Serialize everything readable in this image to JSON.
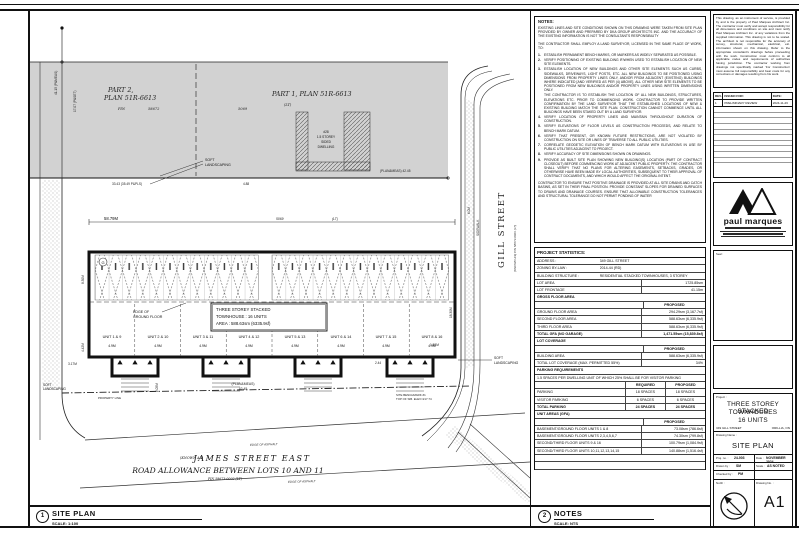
{
  "page": {
    "footer_left": {
      "num": "1",
      "title": "SITE PLAN",
      "scale": "SCALE: 1:100"
    },
    "footer_mid": {
      "num": "2",
      "title": "NOTES",
      "scale": "SCALE: NTS"
    }
  },
  "plan": {
    "part2_line1": "PART 2,",
    "part2_line2": "PLAN 51R-6613",
    "pin_label": "PIN",
    "pin_58672": "58672",
    "part1": "PART 1, PLAN 51R-6613",
    "part1_lt": "(LT)",
    "num_5069": "5069",
    "gill_street": "GILL STREET",
    "gill_known": "(KNOWN AS)   PIN 58673-0001 (LT)",
    "james_known": "(KNOWN AS)",
    "james_street": "JAMES STREET EAST",
    "road_allowance": "ROAD ALLOWANCE BETWEEN LOTS 10 AND 11",
    "james_pin": "PIN 58673-0002 (LT)",
    "soft1": "SOFT",
    "soft2": "LANDSCAPING",
    "edge_asphalt": "EDGE OF ASPHALT",
    "edge_ground1": "EDGE OF",
    "edge_ground2": "GROUND FLOOR",
    "bldg_line1": "THREE STOREY STACKED",
    "bldg_line2": "TOWNHOUSE : 16 UNITS",
    "bldg_line3": "AREA : 588.63sm (6335.9sf)",
    "dwelling": [
      "#28",
      "1.5 STOREY",
      "SIDED",
      "DWELLING"
    ],
    "bubble": "G",
    "units": [
      {
        "label": "UNIT 1 & 9",
        "dim": "4.9M"
      },
      {
        "label": "UNIT 2 & 10",
        "dim": "4.9M"
      },
      {
        "label": "UNIT 3 & 11",
        "dim": "4.9M"
      },
      {
        "label": "UNIT 4 & 12",
        "dim": "4.9M"
      },
      {
        "label": "UNIT 5 & 13",
        "dim": "4.9M"
      },
      {
        "label": "UNIT 6 & 14",
        "dim": "4.9M"
      },
      {
        "label": "UNIT 7 & 15",
        "dim": "4.9M"
      },
      {
        "label": "UNIT 8 & 16",
        "dim": "4.9M"
      }
    ],
    "dims": {
      "top": "58.79M",
      "w1": "41.15 (P&MEAS)",
      "w2": "17.07 (P&SET)",
      "n1": "33.43 (35.49 P&PLS)",
      "n2": "(PLAN&MEAS) 42.45",
      "n3": "4.88",
      "e1": "18.30M",
      "e2": "6.0M",
      "sidewalk": "SIDEWALK",
      "b1": "8.30M",
      "b2": "4.42M",
      "b3": "3.17M",
      "b4": "2.05M",
      "b5": "2.44",
      "b6": "1.50M",
      "s1": "(PLAN&MEAS)",
      "s2": "42.45",
      "bm1": "SITE BENCHMARK #1",
      "bm2": "TOP OF SIB. ELEV=217.74",
      "prop": "PROPERTY LINE"
    }
  },
  "notes_panel": {
    "title": "NOTES:",
    "para1": "EXISTING LINES AND SITE CONDITIONS SHOWN ON THIS DRAWING WERE TAKEN FROM SITE PLAN PROVIDED BY OWNER AND PREPARED BY DKA GROUP ARCHITECTS INC. AND THE ACCURACY OF THE EXISTING INFORMATION IS NOT THE CONSULTANTS RESPONSIBILITY",
    "para2": "THE CONTRACTOR SHALL EMPLOY A LAND SURVEYOR, LICENSED IN THE SAME PLACE OF WORK, TO:",
    "items": [
      {
        "n": "1.",
        "t": "ESTABLISH PERMANENT BENCH MARKS, OR MARKERS AS WIDELY SEPARATED AS POSSIBLE."
      },
      {
        "n": "2.",
        "t": "VERIFY POSITIONING OF EXISTING BUILDING IF/WHEN USED TO ESTABLISH LOCATION OF NEW SITE ELEMENTS."
      },
      {
        "n": "3.",
        "t": "ESTABLISH LOCATION OF NEW BUILDINGS AND OTHER SITE ELEMENTS SUCH AS CURBS, SIDEWALKS, DRIVEWAYS, LIGHT POSTS, ETC. ALL NEW BUILDINGS TO BE POSITIONED USING DIMENSIONS FROM PROPERTY LINES ONLY, AND/OR FROM ADJACENT (EXISTING) BUILDINGS WHERE INDICATED [AND VERIFIED AS PER (4) ABOVE]. ALL OTHER NEW SITE ELEMENTS TO BE POSITIONED FROM NEW BUILDINGS AND/OR PROPERTY LINES USING WRITTEN DIMENSIONS ONLY."
      },
      {
        "n": "",
        "t": "THE CONTRACTOR IS TO ESTABLISH THE LOCATION OF ALL NEW BUILDINGS, STRUCTURES, ELEVATIONS ETC. PRIOR TO COMMENCING WORK. CONTRACTOR TO PROVIDE WRITTEN CONFIRMATION BY THE LAND SURVEYOR THAT THE ESTABLISHED LOCATIONS OF NEW & EXISTING BUILDING MATCH THE SITE PLAN. CONSTRUCTION CANNOT COMMENCE UNTIL ALL BUILDINGS HAVE BEEN STAKED OUT BY A LAND SURVEYOR."
      },
      {
        "n": "4.",
        "t": "VERIFY LOCATION OF PROPERTY LINES AND MAINTAIN THROUGHOUT DURATION OF CONSTRUCTION."
      },
      {
        "n": "5.",
        "t": "VERIFY ELEVATIONS OF FLOOR LEVELS AS CONSTRUCTION PROCEEDS, AND RELATE TO BENCH MARK DATUM."
      },
      {
        "n": "6.",
        "t": "VERIFY THAT PRESENT, OR KNOWN FUTURE RESTRICTIONS, ARE NOT VIOLATED BY CONSTRUCTION ON SITE OR LINES OF TRAVERSE TO ALL PUBLIC UTILITIES."
      },
      {
        "n": "7.",
        "t": "CORRELATE GEODETIC ELEVATION OF BENCH MARK DATUM WITH ELEVATIONS IN USE BY PUBLIC UTILITIES ADJACENT TO PROJECT."
      },
      {
        "n": "8.",
        "t": "VERIFY ACCURACY OF SITE DIMENSIONS SHOWN ON DRAWINGS."
      },
      {
        "n": "9.",
        "t": "PROVIDE AS BUILT SITE PLAN SHOWING NEW BUILDING(S) LOCATION (PART OF CONTRACT CLOSEOUT) BEFORE COMMENCING WORK AT ADJACENT PUBLIC PROPERTY. THE CONTRACTOR SHALL VERIFY THAT NO PLANS FOR ALTERING EASEMENTS, SETBACKS, GRADES, OR OTHERWISE HAVE BEEN MADE BY LOCAL AUTHORITIES, SUBSEQUENT TO THEIR APPROVAL OF CONTRACT DOCUMENTS, AND WHICH WOULD AFFECT THE ORIGINAL INTENT."
      }
    ],
    "closing": "CONTRACTOR TO ENSURE THAT POSITIVE DRAINAGE IS PROVIDED AT ALL SITE DRAINS AND CATCH BASINS, AS SET IN THEIR FINAL POSITION. PROVIDE CONSTANT SLOPES FOR DRAINED SURFACES TO DRAINS AND DRAINAGE COURSES. ENSURE THAT ALLOWABLE CONSTRUCTION TOLERANCES AND STRUCTURAL TOLERANCE DO NOT PERMIT PONDING OF WATER"
  },
  "stats": {
    "title": "PROJECT STATISTICS:",
    "rows": [
      {
        "l": "ADDRESS :",
        "v": "349 GILL STREET"
      },
      {
        "l": "ZONING BY-LAW :",
        "v": "2014-44 (RD)"
      },
      {
        "l": "BUILDING STRUCTURE :",
        "v": "RESIDENTIAL STACKED TOWNHOUSES, 3 STOREY"
      },
      {
        "l": "LOT AREA",
        "v": "1725.85sm"
      },
      {
        "l": "LOT FRONTAGE",
        "v": "41.15m"
      },
      {
        "l": "GROSS FLOOR AREA",
        "v": ""
      },
      {
        "l": "",
        "v": "PROPOSED"
      },
      {
        "l": "GROUND FLOOR AREA",
        "v": "294.29sm (3,167.7sf)"
      },
      {
        "l": "SECOND FLOOR AREA",
        "v": "588.63sm (6,335.9sf)"
      },
      {
        "l": "THIRD FLOOR AREA",
        "v": "588.63sm (6,335.9sf)"
      },
      {
        "l": "TOTAL GFA (NO GARAGE)",
        "v": "1,471.55sm (15,839.8sf)"
      },
      {
        "l": "LOT COVERAGE",
        "v": ""
      },
      {
        "l": "",
        "v": "PROPOSED"
      },
      {
        "l": "BUILDING AREA",
        "v": "588.63sm (6,335.9sf)"
      },
      {
        "l": "TOTAL LOT COVERAGE (MAX. PERMITTED 55%)",
        "v": "34%"
      },
      {
        "l": "PARKING REQUIREMENTS",
        "v": ""
      },
      {
        "l": "1.5 SPACES PER DWELLING UNIT OF WHICH 25% SHALL BE FOR VISITOR PARKING",
        "v": ""
      },
      {
        "l": "",
        "c": "REQUIRED",
        "v": "PROPOSED"
      },
      {
        "l": "PARKING",
        "c": "18 SPACES",
        "v": "18 SPACES"
      },
      {
        "l": "VISITOR PARKING",
        "c": "6 SPACES",
        "v": "6 SPACES"
      },
      {
        "l": "TOTAL PARKING",
        "c": "24 SPACES",
        "v": "24 SPACES"
      },
      {
        "l": "UNIT AREAS (GFA)",
        "v": ""
      },
      {
        "l": "",
        "v": "PROPOSED"
      },
      {
        "l": "BASEMENT/GROUND FLOOR UNITS 1 & 8",
        "v": "73.08sm (786.6sf)"
      },
      {
        "l": "BASEMENT/GROUND FLOOR UNITS 2,3,4,5,6,7",
        "v": "74.30sm (799.8sf)"
      },
      {
        "l": "SECOND/THIRD FLOOR UNITS 9 & 16",
        "v": "100.79sm (1,084.9sf)"
      },
      {
        "l": "SECOND/THIRD FLOOR UNITS 10,11,12,13,14,15",
        "v": "140.88sm (1,516.4sf)"
      }
    ]
  },
  "right_panel": {
    "disclaimer": "This drawing, as an instrument of service, is provided by and is the property of Paul Marques Architect Inc. The contractor must verify and accept responsibility for all dimensions and conditions on site and must notify Paul Marques Architect Inc. of any variations from the supplied information. This drawing is not to be scaled. The architect is not responsible for the accuracy of survey, structural, mechanical, electrical, etc. information shown on this drawing. Refer to the appropriate consultant's drawings before proceeding with the work. Construction must conform to all applicable codes and requirements of authorities having jurisdiction. The contractor working from drawings not specifically marked 'For Construction' must assume full responsibility and bear costs for any corrections or damages resulting from his work.",
    "revisions": {
      "h1": "REV.",
      "h2": "ISSUED FOR:",
      "h3": "DATE:",
      "r1_rev": "1",
      "r1_issued": "PRELIMINARY REVIEW",
      "r1_date": "2024-11-26"
    },
    "logo": {
      "name": "paul marques"
    },
    "seal_label": "Seal :",
    "titleblock": {
      "project_label": "Project :",
      "name1": "THREE STOREY STACKED",
      "name2": "TOWNHOUSES",
      "name3": "16 UNITS",
      "addr_left": "349 GILL STREET",
      "addr_right": "ORILLIA, ON",
      "drawing_name_label": "Drawing Name :",
      "drawing_name": "SITE PLAN",
      "projno_label": "Proj. no. :",
      "projno": "24-003",
      "date_label": "Date :",
      "date": "NOVEMBER 2024",
      "drawn_label": "Drawn by :",
      "drawn": "SM",
      "scale_label": "Scale :",
      "scale": "AS NOTED",
      "checked_label": "Checked by :",
      "checked": "PM",
      "north_label": "North :",
      "dwgno_label": "Drawing No. :",
      "dwgno": "A1"
    }
  }
}
